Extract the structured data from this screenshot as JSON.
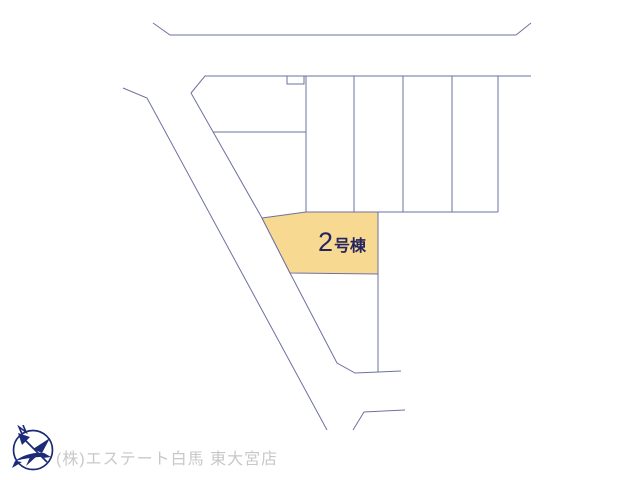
{
  "canvas": {
    "width": 640,
    "height": 480,
    "background": "#ffffff"
  },
  "site_plan": {
    "outline_color": "#6e71a1",
    "highlighted_plot": {
      "number": "2",
      "suffix": "号棟",
      "full_label": "2号棟",
      "fill_color": "#f8d992",
      "label_color": "#24245e"
    }
  },
  "compass": {
    "icon": "north-compass",
    "color": "#1c2a78"
  },
  "footer": {
    "company_name": "(株)エステート白馬 東大宮店",
    "text_color": "#c8c8c8"
  }
}
